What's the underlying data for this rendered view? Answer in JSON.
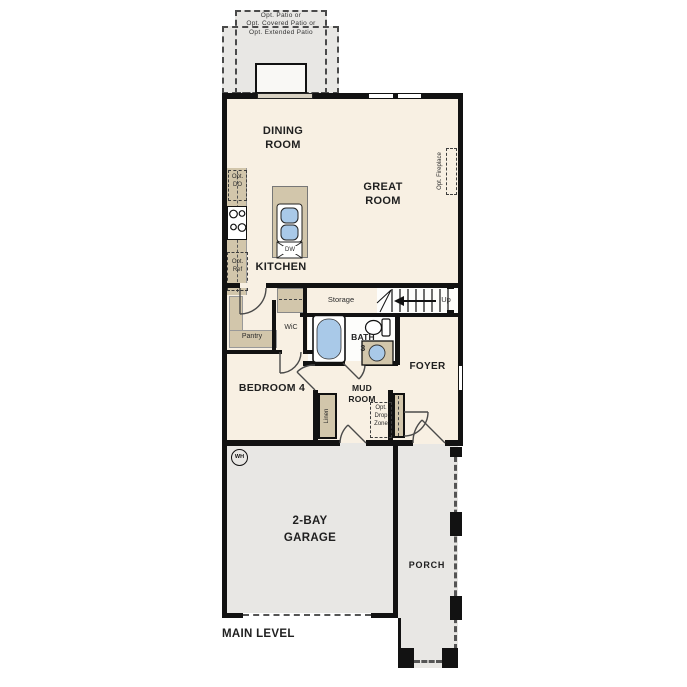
{
  "colors": {
    "floor": "#f8f0e3",
    "concrete": "#e8e7e4",
    "cabinet": "#d2c6ab",
    "fixture": "#a9c9e8",
    "wall": "#121212",
    "text": "#202020"
  },
  "patio": {
    "label": "Opt. Patio or\nOpt. Covered Patio or\nOpt. Extended Patio"
  },
  "rooms": {
    "dining": "DINING\nROOM",
    "great": "GREAT\nROOM",
    "kitchen": "KITCHEN",
    "storage": "Storage",
    "pantry": "Pantry",
    "wic": "WiC",
    "bath3": "BATH\n3",
    "foyer": "FOYER",
    "bedroom4": "BEDROOM 4",
    "mudroom": "MUD\nROOM",
    "garage": "2-BAY\nGARAGE",
    "porch": "PORCH"
  },
  "features": {
    "up": "Up",
    "linen": "Linen",
    "drop_zone": "Opt.\nDrop\nZone",
    "fireplace": "Opt. Fireplace",
    "double_oven": "Opt.\nDO",
    "refrigerator": "Opt.\nRef",
    "dishwasher": "DW",
    "water_heater": "WH"
  },
  "footer": {
    "level_label": "MAIN LEVEL"
  }
}
